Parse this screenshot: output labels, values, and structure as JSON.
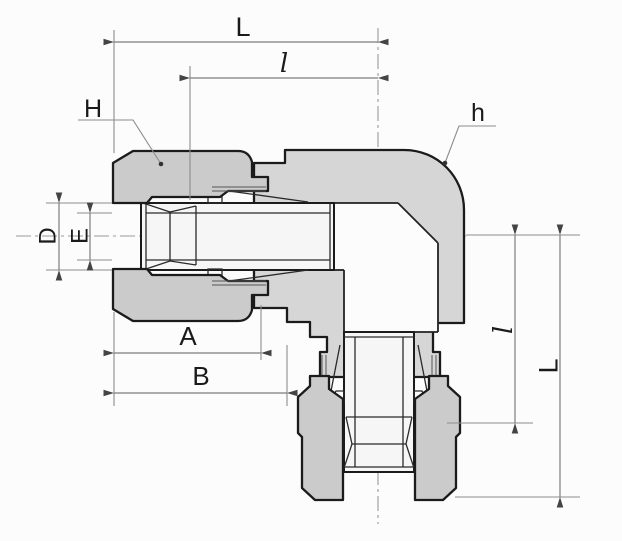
{
  "labels": {
    "top_length": "L",
    "top_insert": "l",
    "nut_hex": "H",
    "body_hex": "h",
    "hole_dia": "D",
    "bore_dia": "E",
    "nut_len": "A",
    "body_len": "B",
    "side_insert": "l",
    "side_length": "L"
  },
  "colors": {
    "background": "#fcfcfc",
    "metal_fill": "#d6d6d6",
    "nut_fill": "#cbcbcb",
    "tube_fill": "#f6f6f6",
    "outline": "#1b1b1b",
    "dimension_line": "#7d7d7d",
    "label_text": "#1a1a1a"
  }
}
